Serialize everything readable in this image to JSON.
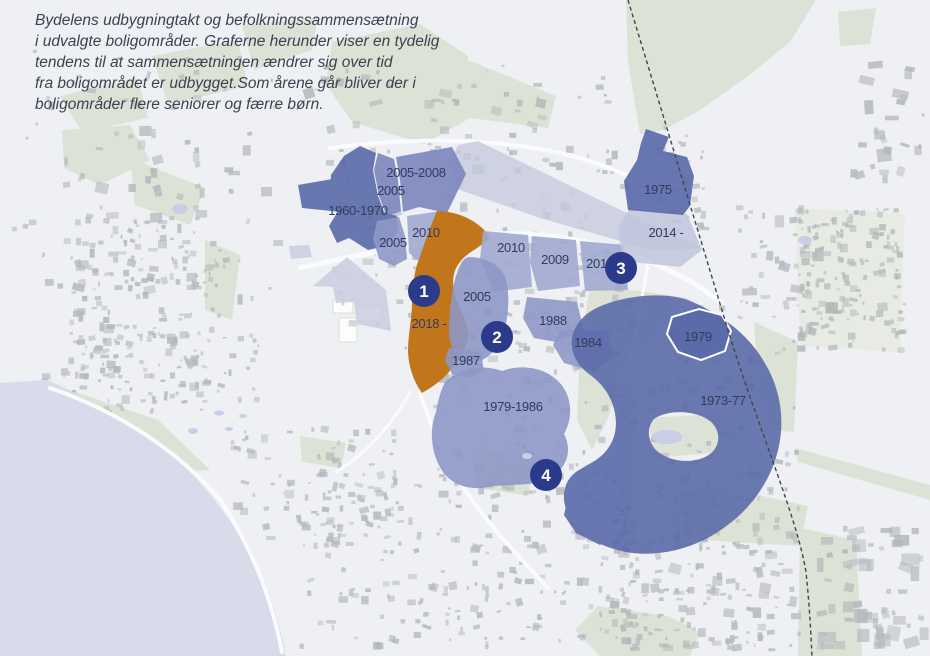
{
  "header": {
    "lines": [
      "Bydelens udbygningtakt og befolkningssammensætning",
      "i udvalgte boligområder. Graferne herunder viser en tydelig",
      "tendens til at sammensætningen ændrer sig over tid",
      "fra boligområdet er udbygget.Som årene går bliver der i",
      "boligområder flere seniorer og færre børn."
    ]
  },
  "map": {
    "regions": [
      {
        "label": "1960-1970"
      },
      {
        "label": "2005-2008"
      },
      {
        "label": "2005"
      },
      {
        "label": "2010"
      },
      {
        "label": "2005"
      },
      {
        "label": "2018 -"
      },
      {
        "label": "2010"
      },
      {
        "label": "2009"
      },
      {
        "label": "2015"
      },
      {
        "label": "2014 -"
      },
      {
        "label": "1975"
      },
      {
        "label": "2005"
      },
      {
        "label": "1988"
      },
      {
        "label": "1984"
      },
      {
        "label": "1987"
      },
      {
        "label": "1979-1986"
      },
      {
        "label": "1979"
      },
      {
        "label": "1973-77"
      }
    ],
    "markers": [
      {
        "number": "1"
      },
      {
        "number": "2"
      },
      {
        "number": "3"
      },
      {
        "number": "4"
      }
    ],
    "palette": {
      "dark_blue": "#5b6aa9",
      "medium_blue": "#7a86bd",
      "mid_blue": "#8d98c6",
      "light_blue": "#a0aad0",
      "pale_lavender": "#c6cade",
      "orange": "#c1761c",
      "marker_navy": "#2c3a8c",
      "water": "#d9dbeb",
      "green": "#dce3d6",
      "label_text": "#323a5e",
      "header_text": "#3b4250"
    }
  }
}
